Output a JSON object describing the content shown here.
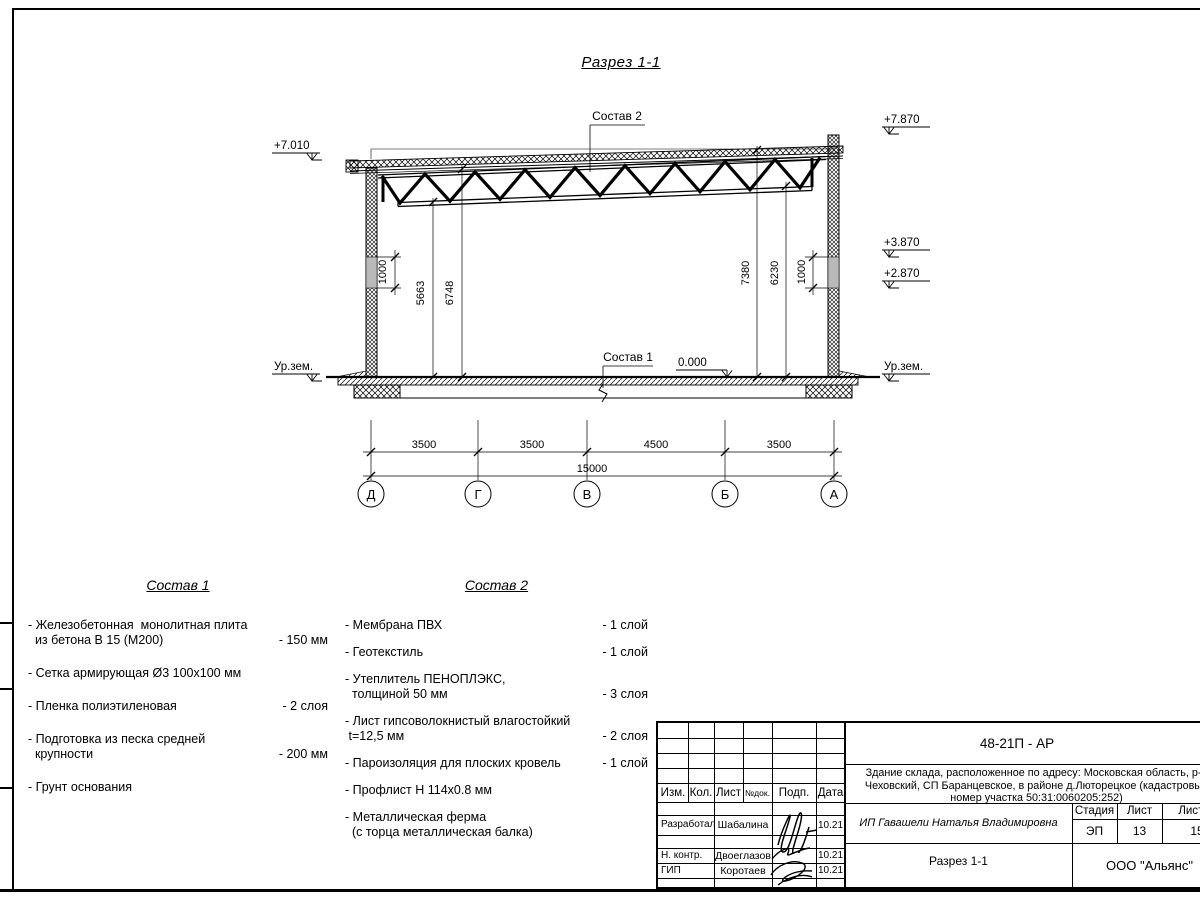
{
  "drawing_title": "Разрез 1-1",
  "section": {
    "sostav2_label": "Состав 2",
    "sostav1_label": "Состав 1",
    "elevations": {
      "left_top": "+7.010",
      "left_ground": "Ур.зем.",
      "right_top": "+7.870",
      "right_mid1": "+3.870",
      "right_mid2": "+2.870",
      "right_ground": "Ур.зем.",
      "floor_zero": "0.000"
    },
    "vertical_dims": {
      "left": [
        "1000",
        "5663",
        "6748"
      ],
      "right": [
        "7380",
        "6230",
        "1000"
      ]
    },
    "horizontal_dims": {
      "segments": [
        "3500",
        "3500",
        "4500",
        "3500"
      ],
      "total": "15000"
    },
    "axes": [
      "Д",
      "Г",
      "В",
      "Б",
      "А"
    ]
  },
  "sostav1": {
    "heading": "Состав 1",
    "items": [
      {
        "name": "- Железобетонная  монолитная плита\n  из бетона В 15 (М200)",
        "qty": "- 150 мм"
      },
      {
        "name": "- Сетка армирующая Ø3 100х100 мм",
        "qty": ""
      },
      {
        "name": "- Пленка полиэтиленовая",
        "qty": "-  2 слоя"
      },
      {
        "name": "- Подготовка из песка средней\n  крупности",
        "qty": "- 200 мм"
      },
      {
        "name": "- Грунт основания",
        "qty": ""
      }
    ]
  },
  "sostav2": {
    "heading": "Состав 2",
    "items": [
      {
        "name": "- Мембрана ПВХ",
        "qty": "- 1 слой"
      },
      {
        "name": "- Геотекстиль",
        "qty": "- 1 слой"
      },
      {
        "name": "- Утеплитель ПЕНОПЛЭКС,\n  толщиной 50 мм",
        "qty": "- 3 слоя"
      },
      {
        "name": "- Лист гипсоволокнистый влагостойкий\n t=12,5 мм",
        "qty": "- 2 слоя"
      },
      {
        "name": "- Пароизоляция для плоских кровель",
        "qty": "- 1 слой"
      },
      {
        "name": "- Профлист Н 114х0.8 мм",
        "qty": ""
      },
      {
        "name": "- Металлическая ферма\n  (с торца металлическая балка)",
        "qty": ""
      }
    ]
  },
  "titleblock": {
    "doc_number": "48-21П - АР",
    "project_lines": [
      "Здание склада, расположенное по адресу: Московская область, р-н",
      "Чеховский, СП Баранцевское, в районе д.Люторецкое  (кадастровый",
      "номер участка 50:31:0060205:252)"
    ],
    "header_cols": [
      "Изм.",
      "Кол.",
      "Лист",
      "№док.",
      "Подп.",
      "Дата"
    ],
    "signature_rows": [
      {
        "role": "Разработал",
        "name": "Шабалина",
        "date": "10.21"
      },
      {
        "role": "Н. контр.",
        "name": "Двоеглазов",
        "date": "10.21"
      },
      {
        "role": "ГИП",
        "name": "Коротаев",
        "date": "10.21"
      }
    ],
    "client": "ИП Гавашели Наталья Владимировна",
    "stage_label": "Стадия",
    "sheet_label": "Лист",
    "sheets_label": "Листов",
    "stage": "ЭП",
    "sheet_number": "13",
    "sheets_total": "15",
    "sheet_title": "Разрез 1-1",
    "company": "ООО \"Альянс\""
  }
}
